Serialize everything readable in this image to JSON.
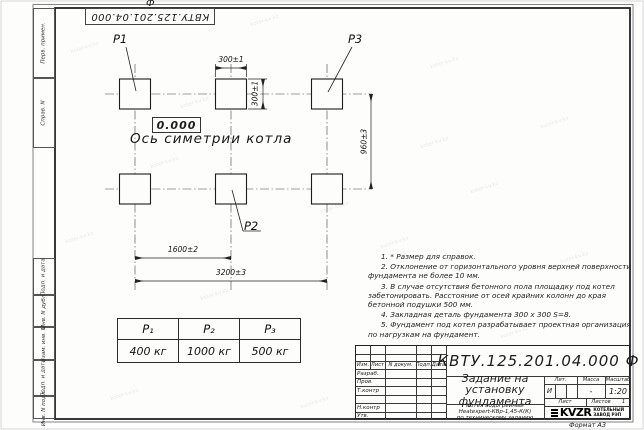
{
  "doc": {
    "number": "КВТУ.125.201.04.000 Ф",
    "format_label": "Формат А3"
  },
  "frame": {
    "left_labels": [
      "Перв. примен.",
      "Справ. N",
      "Подп. и дата",
      "Инв. N дубл.",
      "Взам. инв. N",
      "Подп. и дата",
      "Инв. N подл."
    ]
  },
  "drawing": {
    "point_labels": {
      "p1": "P1",
      "p2": "P2",
      "p3": "P3"
    },
    "level_mark": "0.000",
    "axis_label": "Ось симетрии котла",
    "dimensions": {
      "pad_width": "300±1",
      "pad_height": "300±1",
      "row_spacing": "960±3",
      "col_spacing": "1600±2",
      "total_width": "3200±3"
    }
  },
  "notes": [
    "1. * Размер для справок.",
    "2. Отклонение от горизонтального уровня верхней поверхности фундамента не более 10 мм.",
    "3. В случае отсутствия бетонного пола площадку под котел забетонировать. Расстояние от осей крайних колонн до края бетонной подушки 500 мм.",
    "4. Закладная деталь фундамента  300 х 300  S=8.",
    "5. Фундамент под котел разрабатывает проектная организация по нагрузкам на фундамент."
  ],
  "load_table": {
    "headers": [
      "P₁",
      "P₂",
      "P₃"
    ],
    "values": [
      "400 кг",
      "1000 кг",
      "500 кг"
    ]
  },
  "title_block": {
    "header_cols": {
      "izm": "Изм.",
      "list": "Лист",
      "doc": "N докум.",
      "podp": "Подп.",
      "data": "Дата"
    },
    "sign_rows": {
      "razrab": "Разраб.",
      "prov": "Пров.",
      "tkontr": "Т.контр",
      "nkontr": "Н.контр",
      "utv": "Утв."
    },
    "title": "Задание на установку фундамента",
    "subtitle_line1": "Котел водогрейный",
    "subtitle_line2": "Heatexpert-КВр-1,45-К(К)",
    "subtitle_line3": "по техническому заданию",
    "lit_label": "Лит.",
    "lit_value": "И",
    "mass_label": "Масса",
    "mass_value": "-",
    "scale_label": "Масштаб",
    "scale_value": "1:20",
    "sheet_label": "Лист",
    "sheets_label": "Листов",
    "sheets_value": "1",
    "logo_text": "KVZR",
    "logo_caption_line1": "КОТЕЛЬНЫЙ",
    "logo_caption_line2": "ЗАВОД РЭП"
  },
  "watermark": "kotel-kv.kz"
}
